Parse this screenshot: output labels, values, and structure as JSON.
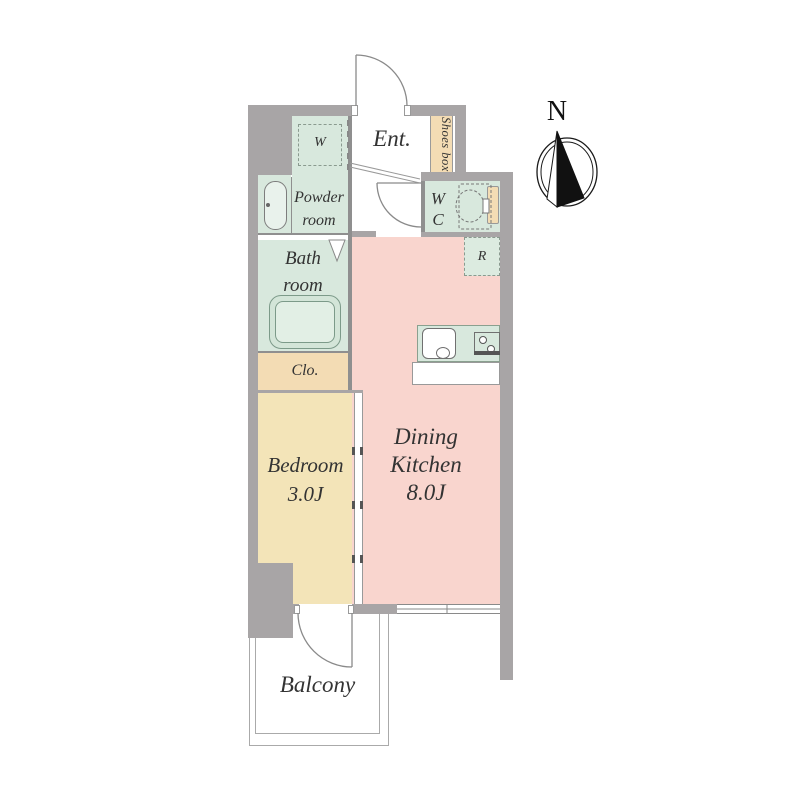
{
  "title": "1K apartment floor plan",
  "colors": {
    "wall": "#a8a5a6",
    "line": "#8f8f8f",
    "green": "#d8e8dd",
    "green_light": "#dcebe0",
    "tan": "#f3dcb4",
    "cream": "#f3e4b8",
    "pink": "#f9d5ce",
    "text": "#333333",
    "compass": "#1a1a1a"
  },
  "rooms": {
    "entrance": {
      "label": "Ent."
    },
    "shoes_box": {
      "label": "Shoes box"
    },
    "washer": {
      "label": "W"
    },
    "powder_room": {
      "lines": [
        "Powder",
        "room"
      ]
    },
    "wc": {
      "lines": [
        "W",
        "C"
      ]
    },
    "fridge": {
      "label": "R"
    },
    "bath_room": {
      "lines": [
        "Bath",
        "room"
      ]
    },
    "closet": {
      "label": "Clo."
    },
    "bedroom": {
      "lines": [
        "Bedroom",
        "3.0J"
      ]
    },
    "dining_kitchen": {
      "lines": [
        "Dining",
        "Kitchen",
        "8.0J"
      ]
    },
    "balcony": {
      "label": "Balcony"
    }
  },
  "compass": {
    "label": "N"
  }
}
